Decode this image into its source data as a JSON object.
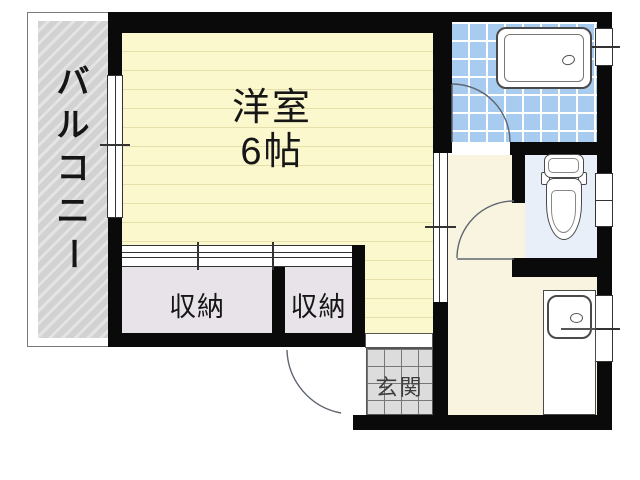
{
  "plan": {
    "type": "apartment-floor-plan",
    "labels": {
      "balcony": "バルコニー",
      "balcony_chars": [
        "バ",
        "ル",
        "コ",
        "ニ",
        "ー"
      ],
      "main_room_name": "洋室",
      "main_room_size": "6帖",
      "closet_left": "収納",
      "closet_right": "収納",
      "entrance": "玄関"
    },
    "rooms": [
      {
        "name": "balcony",
        "label": "バルコニー"
      },
      {
        "name": "western-room",
        "label": "洋室 6帖"
      },
      {
        "name": "closet-left",
        "label": "収納"
      },
      {
        "name": "closet-right",
        "label": "収納"
      },
      {
        "name": "entrance",
        "label": "玄関"
      },
      {
        "name": "bathroom",
        "label": ""
      },
      {
        "name": "toilet",
        "label": ""
      },
      {
        "name": "kitchen-hall",
        "label": ""
      }
    ],
    "colors": {
      "wall": "#0a0a0a",
      "room_floor": "#fbf8cd",
      "room_floor_line": "#e6dfac",
      "hall_floor": "#f8f4df",
      "bath_tile": "#a7ccf0",
      "toilet_floor": "#e9eff8",
      "closet_fill": "#e7e3e9",
      "entrance_tile": "#dcdcdc",
      "balcony_fill": "#d2d2d2",
      "outline": "#555555"
    }
  }
}
